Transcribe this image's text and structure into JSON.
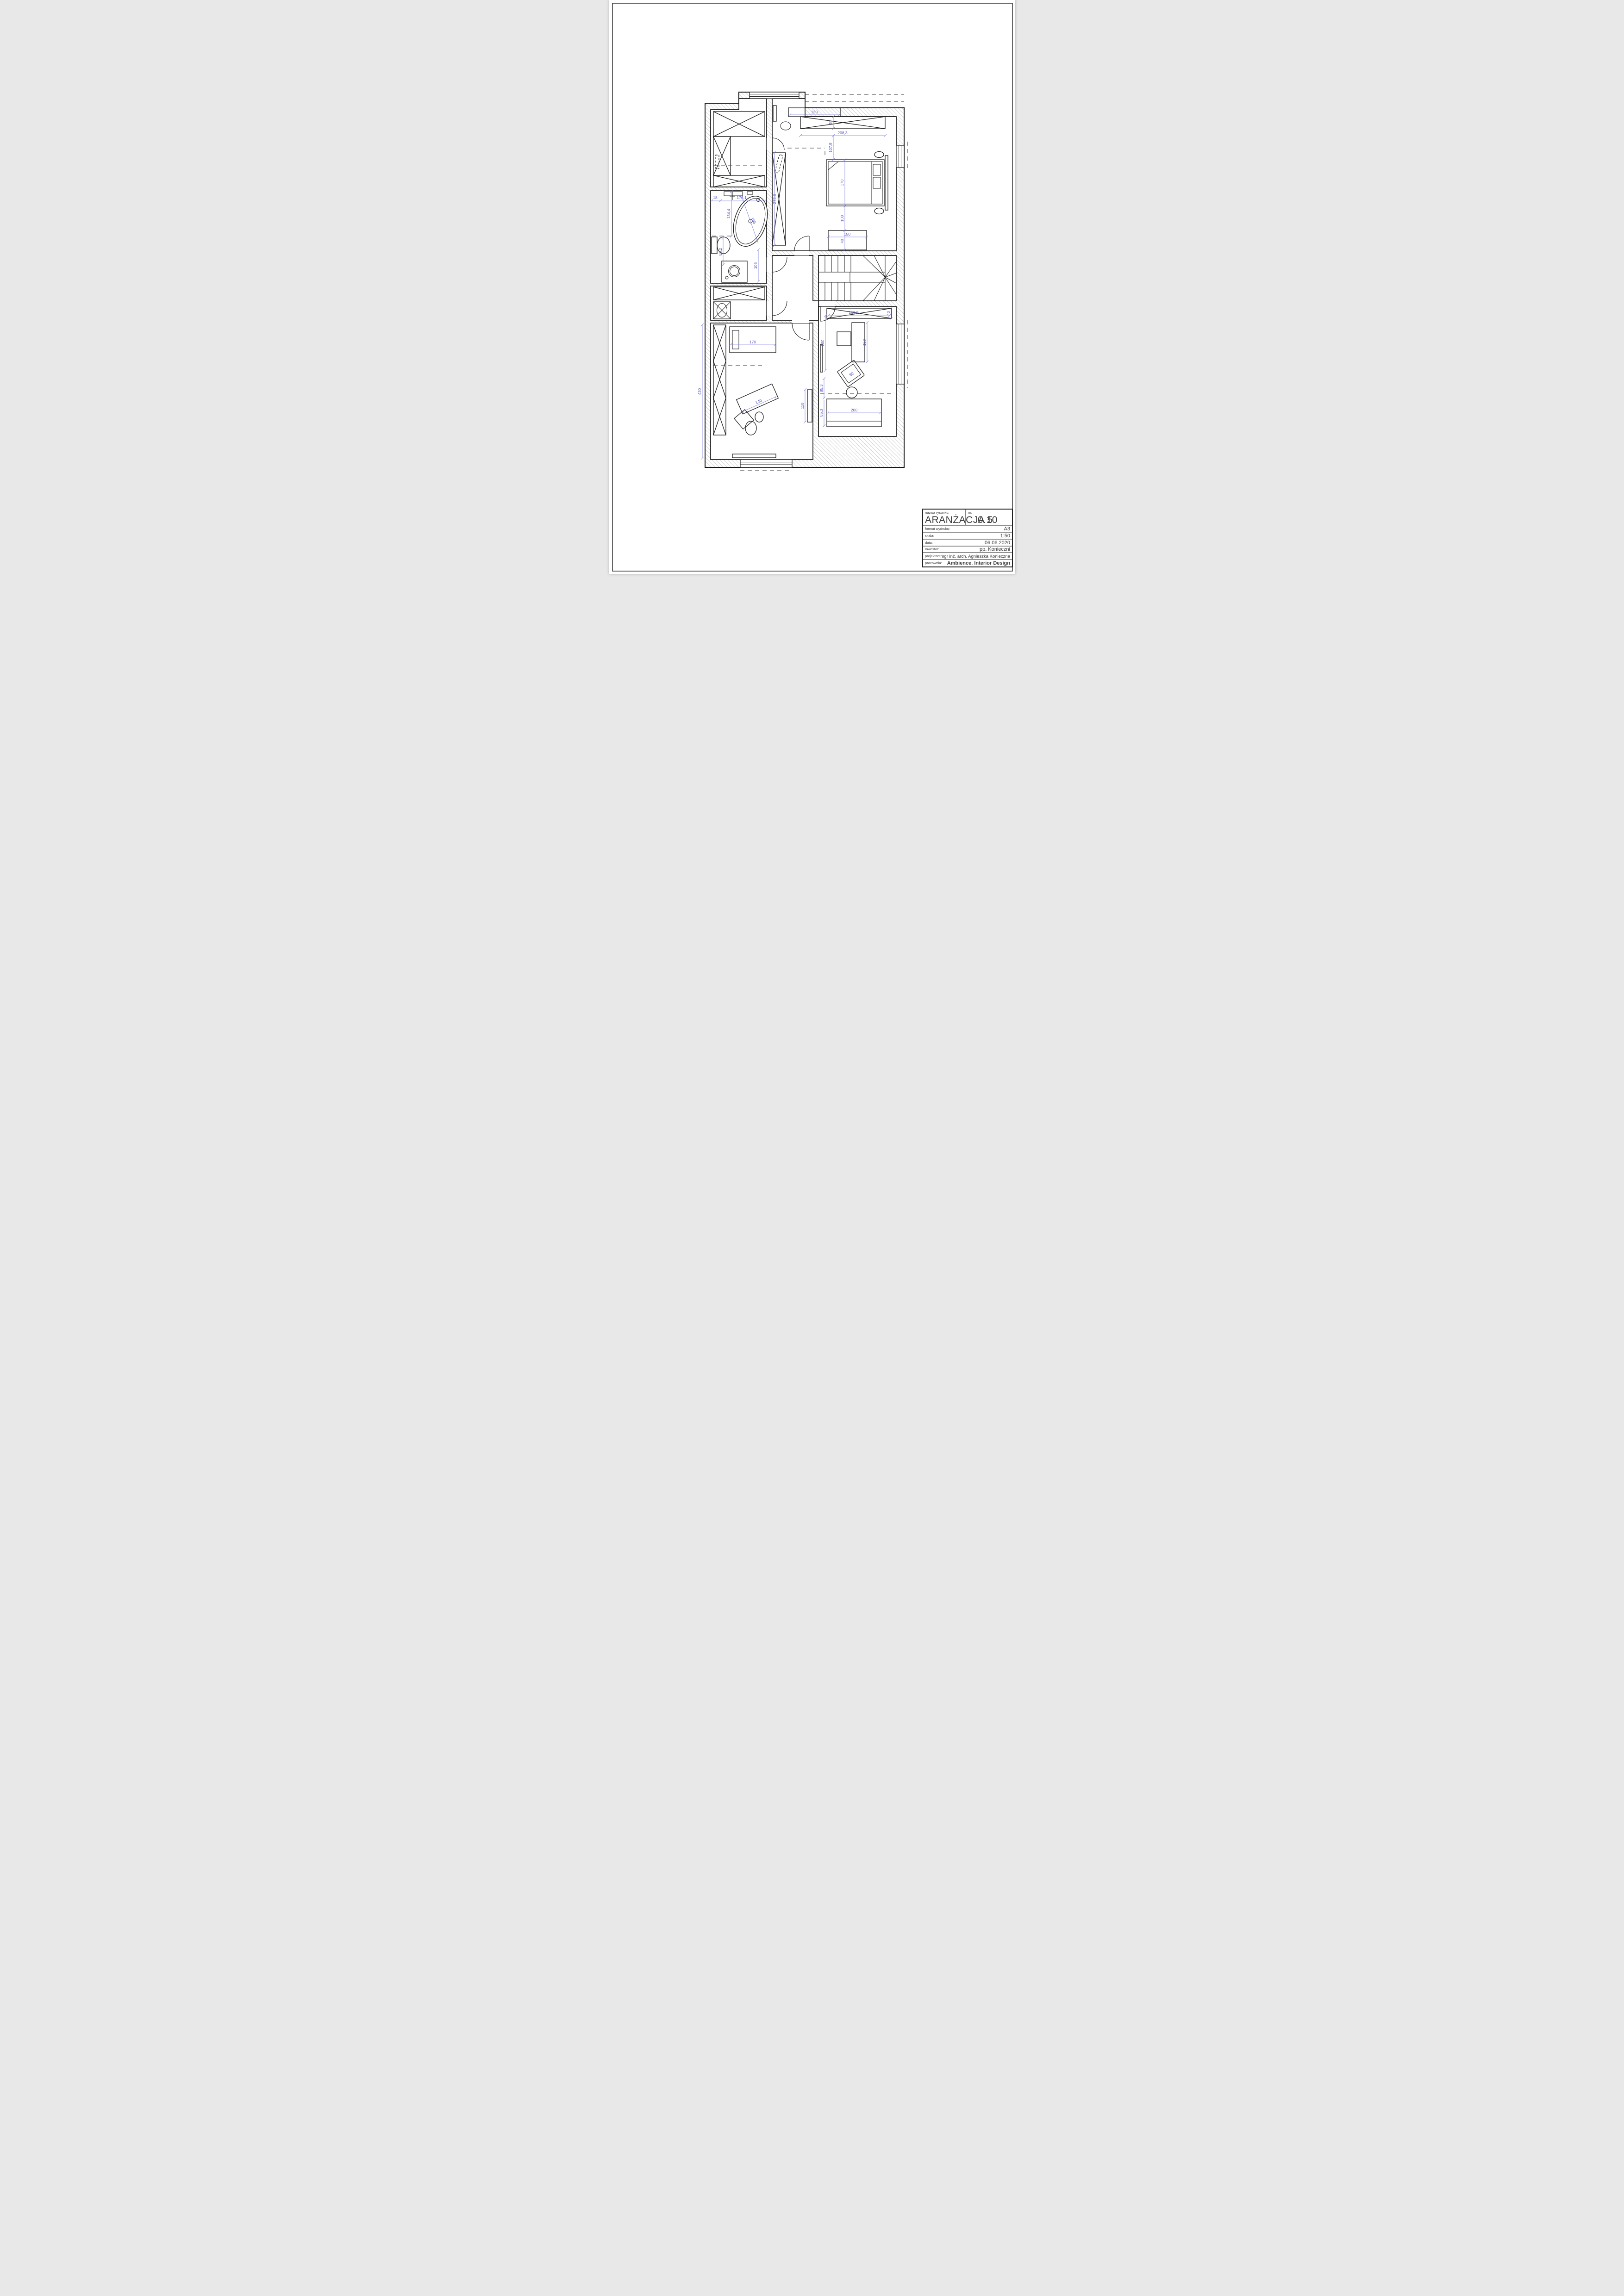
{
  "title_block": {
    "name_label": "nazwa rysunku:",
    "name_value": "ARANŻACJA 5",
    "number_label": "nr:",
    "number_value": "0.10",
    "format_label": "format wydruku:",
    "format_value": "A3",
    "scale_label": "skala:",
    "scale_value": "1:50",
    "date_label": "data:",
    "date_value": "06.06.2020",
    "investor_label": "Inwestor:",
    "investor_value": "pp. Konieczni",
    "designer_label": "projektant:",
    "designer_value": "mgr inż. arch. Agnieszka Konieczna",
    "studio_label": "pracownia:",
    "studio_value": "Ambience. Interior Design"
  },
  "dimensions": {
    "dresser_width": "130",
    "wardrobe_depth": "45",
    "wardrobe_width": "208,3",
    "bed_offset": "107,9",
    "bed_length": "170",
    "bed_to_bench": "100",
    "bench_width": "150",
    "bench_depth": "40",
    "tall_wardrobe_height": "273,6",
    "bath_niche": "18",
    "bath_width": "176,1",
    "bath_left_upper": "134,4",
    "bath_left_lower": "86,2",
    "bath_sink": "106",
    "tub_diagonal": "165",
    "kids_room_height": "430",
    "kids_bed_length": "170",
    "kids_desk_width": "140",
    "kids_shelf": "110",
    "understair_wardrobe_width": "168,9",
    "understair_wardrobe_depth": "40",
    "desk_length": "150",
    "tv_wall": "200",
    "armchair_width": "80",
    "sofa_offset_upper": "85,3",
    "sofa_offset_lower": "85,3",
    "sofa_length": "200"
  }
}
